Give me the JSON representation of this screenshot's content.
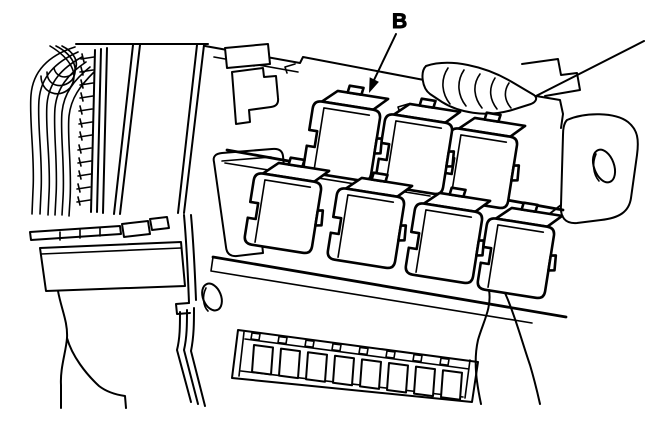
{
  "figure": {
    "callout": {
      "label": "B"
    },
    "colors": {
      "line": "#000000",
      "background": "#ffffff"
    }
  }
}
